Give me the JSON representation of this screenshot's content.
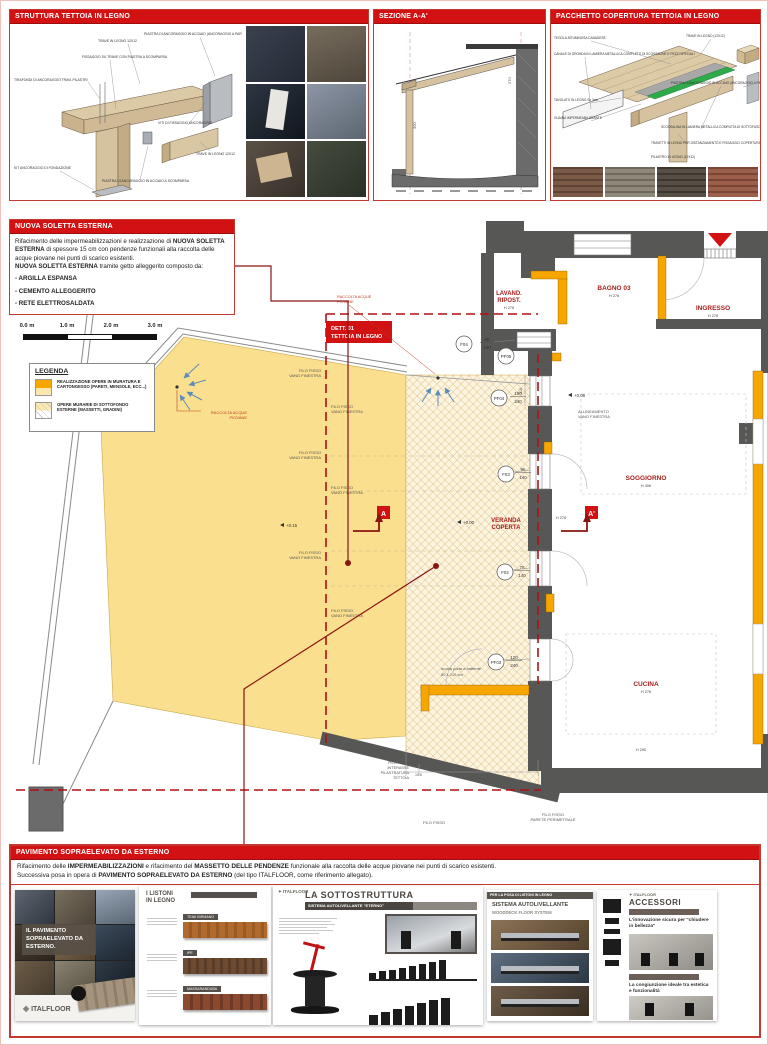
{
  "colors": {
    "header_red": "#d21113",
    "dark_red": "#a5201d",
    "terrace_yellow": "#fadf8e",
    "new_wall_orange": "#f7a600",
    "wall_gray": "#575756",
    "membrane_green": "#2faa4a",
    "wood_tan": "#d8c6a4"
  },
  "top_panels": {
    "struttura": {
      "title": "STRUTTURA TETTOIA IN LEGNO",
      "labels": [
        "TIRAFONDI DI ANCORAGGIO TRAVI-PILASTRI",
        "TRAVE IN LEGNO 12X12",
        "FISSAGGIO SU TRAVE CON PIASTRA A SCOMPARSA",
        "PIASTRA DI ANCORAGGIO IN ACCIAIO (ANCORAGGIO A PARETE)",
        "VITI DI FISSAGGIO ANCORAGGIO",
        "TRAVE IN LEGNO 12X12",
        "PIASTRA DI ANCORAGGIO IN ACCIAIO A SCOMPARSA",
        "KIT ANCORAGGIO DI FONDAZIONE"
      ]
    },
    "sezione": {
      "title": "SEZIONE A-A'",
      "dim_left": "300",
      "dim_right": "270"
    },
    "pacchetto": {
      "title": "PACCHETTO COPERTURA TETTOIA IN LEGNO",
      "labels_left": [
        "TEGOLA BITUMINOSA CANADESE",
        "CANALE DI GRONDA IN LAMIERA METALLICA COMPLETO DI SCOSSALINE E PEZZI SPECIALI",
        "TAVOLATO IN LEGNO Sp 3cm",
        "GUAINA IMPERMEABILIZZANTE"
      ],
      "labels_right": [
        "TRAVE IN LEGNO (12X12)",
        "PIASTRA DI ANCORAGGIO IN ACCIAIO (ANCORAGGIO A PARETE)",
        "SCOSSALINA IN LAMIERA METALLICA COMPLETA DI SOTTOFASCIA",
        "TRAVETTI IN LEGNO PER DISTANZIAMENTO E FISSAGGIO COPERTURA",
        "PILASTRO IN LEGNO (12X12)"
      ]
    }
  },
  "soletta": {
    "title": "NUOVA SOLETTA ESTERNA",
    "t1": "Rifacimento delle impermeabilizzazioni e realizzazione di ",
    "b1": "NUOVA SOLETTA ESTERNA",
    "t2": " di spessore 15 cm con pendenze funzionali alla raccolta delle acque piovane nei punti di scarico esistenti.",
    "b2": "NUOVA SOLETTA ESTERNA",
    "t3": " tramite getto alleggerito composto da:",
    "bullets": [
      "- ARGILLA ESPANSA",
      "- CEMENTO ALLEGGERITO",
      "- RETE ELETTROSALDATA"
    ]
  },
  "scalebar": {
    "labels": [
      "0.0 m",
      "1.0 m",
      "2.0 m",
      "3.0 m"
    ]
  },
  "legend": {
    "title": "LEGENDA",
    "items": [
      {
        "text": "REALIZZAZIONE OPERE IN MURATURA E CARTONGESSO (PARETI, MENSOLE, ECC...)"
      },
      {
        "text": "OPERE MURARIE DI SOTTOFONDO ESTERNE (MASSETTI, GRADINI)"
      }
    ]
  },
  "plan": {
    "detail": {
      "l1": "DETT. 01",
      "l2": "TETTOIA IN LEGNO"
    },
    "rooms": {
      "lavand": {
        "l1": "LAVAND.",
        "l2": "RIPOST.",
        "h": "H 276"
      },
      "bagno": {
        "name": "BAGNO 03",
        "h": "H 276"
      },
      "ingresso": {
        "name": "INGRESSO",
        "h": "H 276"
      },
      "soggiorno": {
        "name": "SOGGIORNO",
        "h": "H 306"
      },
      "cucina": {
        "name": "CUCINA",
        "h": "H 276"
      },
      "veranda": {
        "l1": "VERANDA",
        "l2": "COPERTA",
        "h": "H 276"
      }
    },
    "windows": {
      "f04": {
        "id": "F04",
        "w": "60",
        "h": "140"
      },
      "pf05": {
        "id": "PF05"
      },
      "pf04": {
        "id": "PF04",
        "w": "100",
        "h": "240"
      },
      "f03": {
        "id": "F03",
        "w": "95",
        "h": "140"
      },
      "f02": {
        "id": "F02",
        "w": "75",
        "h": "140"
      },
      "pf03": {
        "id": "PF03",
        "w": "120",
        "h": "240"
      }
    },
    "levels": {
      "terrace": "+0.15",
      "veranda": "+0.00",
      "interior": "+0.08"
    },
    "labels": {
      "filo_vano_1": "FILO FISSO",
      "filo_vano_2": "VANO FINESTRA",
      "raccolta_1": "RACCOLTA ACQUE",
      "raccolta_2": "PIOVANE",
      "allineamento_1": "ALLINEAMENTO",
      "allineamento_2": "VANO FINESTRA",
      "porta_1": "nuova porta a battente",
      "porta_2": "90 x 210 cm",
      "interasse_1": "FILO FISSO",
      "interasse_2": "INTERASSE",
      "interasse_3": "PILASTRATURA",
      "interasse_4": "TETTOIA",
      "filo": "FILO FISSO",
      "parete_1": "FILO FISSO",
      "parete_2": "PARETE PERIMETRALE",
      "h290": "H 290",
      "dim27": "27",
      "dim195": "19.5",
      "dim280": "280",
      "dim210": "210"
    },
    "markers": {
      "a": "A",
      "a1": "A'"
    }
  },
  "pavimento": {
    "title": "PAVIMENTO SOPRAELEVATO DA ESTERNO",
    "p1a": "Rifacimento delle ",
    "p1b": "IMPERMEABILIZZAZIONI",
    "p1c": " e rifacimento del ",
    "p1d": "MASSETTO DELLE PENDENZE",
    "p1e": " funzionale alla raccolta delle acque piovane nei punti di scarico esistenti.",
    "p2a": "Successiva posa in opera di ",
    "p2b": "PAVIMENTO SOPRAELEVATO DA ESTERNO",
    "p2c": " (del tipo ITALFLOOR, come riferimento allegato)."
  },
  "brochure": {
    "cover": {
      "title": "IL PAVIMENTO SOPRAELEVATO DA ESTERNO.",
      "logo": "ITALFLOOR"
    },
    "listoni": {
      "t1": "I LISTONI",
      "t2": "IN LEGNO",
      "samples": [
        "TEAK BIRMANO",
        "IPE",
        "MASSARANDUBA"
      ]
    },
    "sottostruttura": {
      "logo": "ITALFLOOR",
      "title": "LA SOTTOSTRUTTURA",
      "subtitle": "SISTEMA AUTOLIVELLANTE \"ETERNO\""
    },
    "posa": {
      "banner": "PER LA POSA DI LISTONI IN LEGNO",
      "title": "SISTEMA AUTOLIVELLANTE",
      "subtitle": "WOODDECK FLOOR SYSTEM"
    },
    "accessori": {
      "logo": "ITALFLOOR",
      "title": "ACCESSORI",
      "cap1": "L'innovazione sicura per \"chiudere in bellezza\"",
      "cap2": "La congiunzione ideale tra estetica e funzionalità"
    }
  }
}
